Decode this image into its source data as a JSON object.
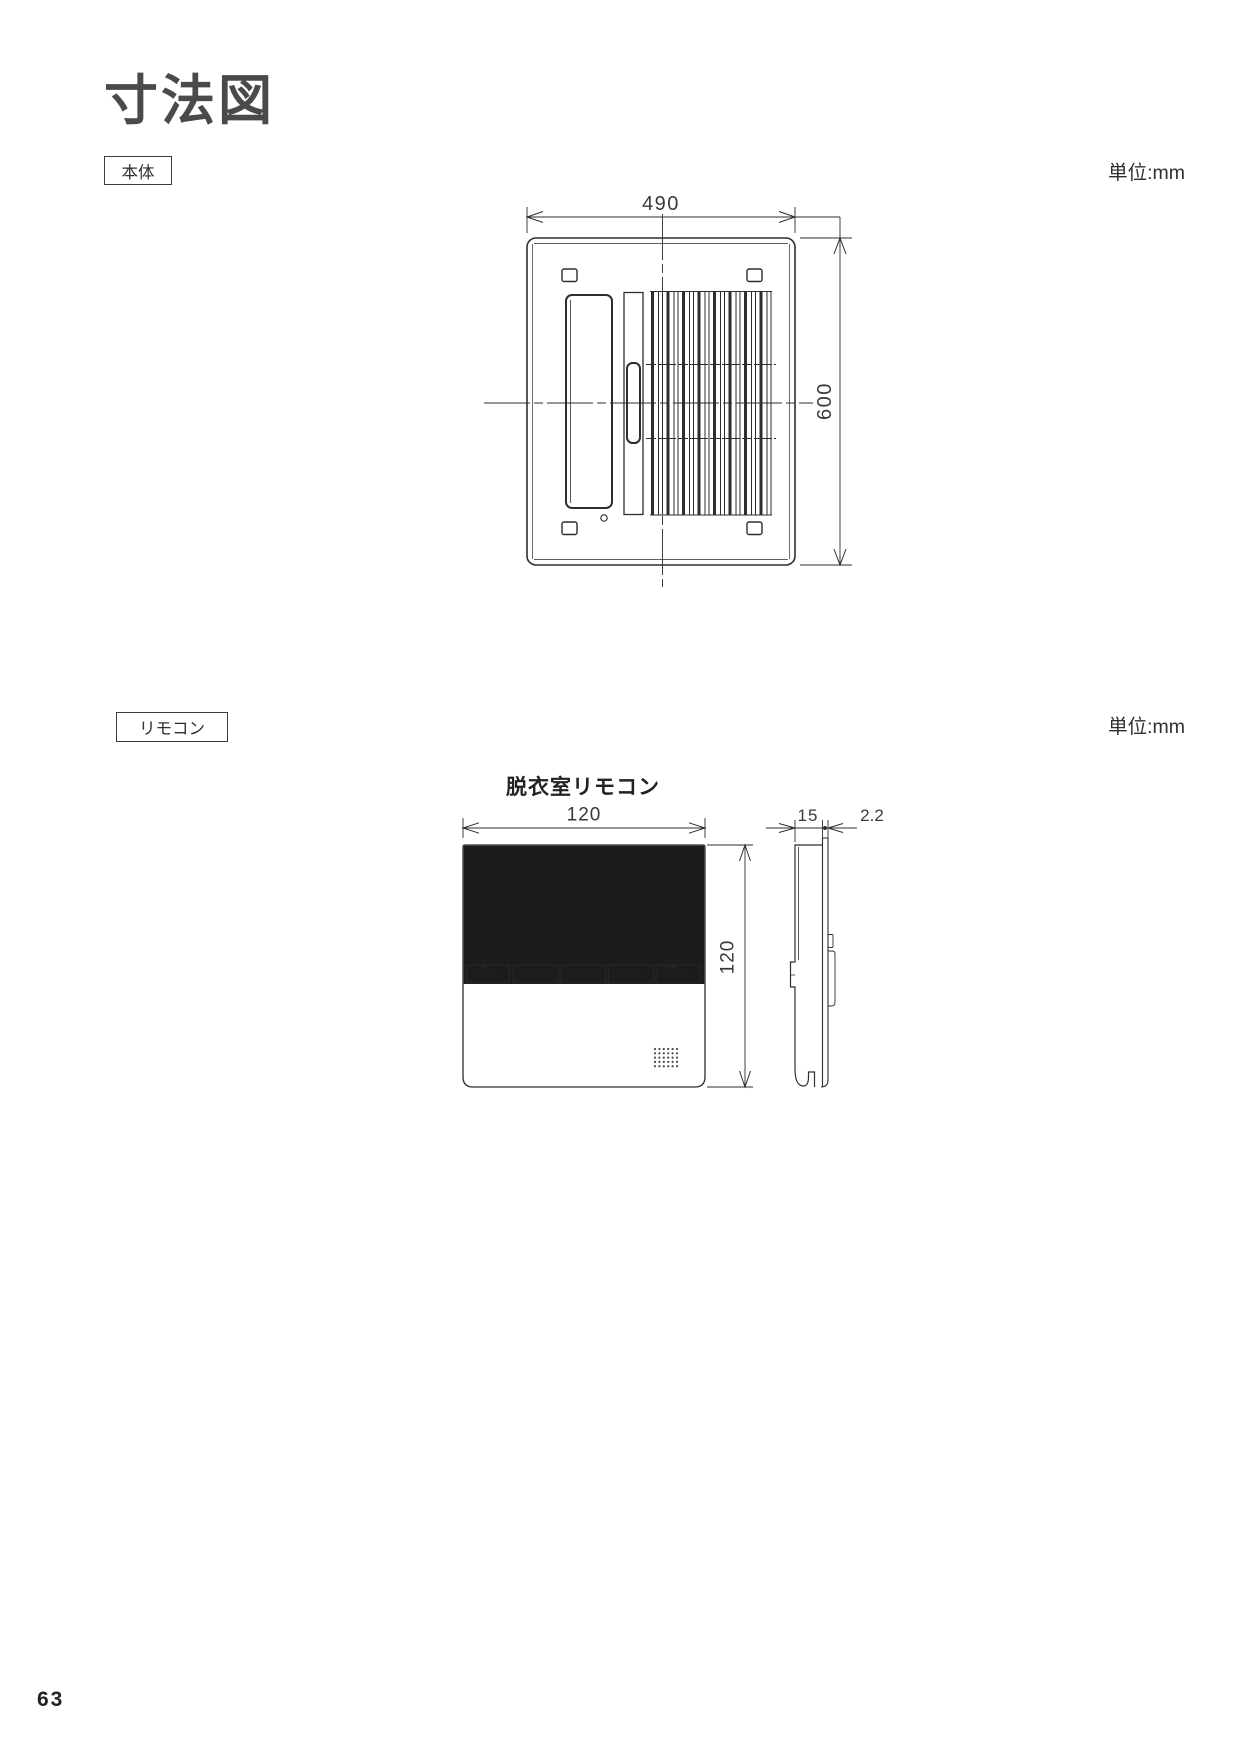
{
  "page": {
    "title": "寸法図",
    "number": "63"
  },
  "body_section": {
    "label": "本体",
    "unit": "単位:mm",
    "width_mm": "490",
    "height_mm": "600"
  },
  "remote_section": {
    "label": "リモコン",
    "unit": "単位:mm",
    "subtitle": "脱衣室リモコン",
    "front": {
      "width_mm": "120",
      "height_mm": "120",
      "buttons": [
        "暖房",
        "衣類乾燥",
        "浴室乾燥",
        "換気",
        "停止"
      ]
    },
    "side": {
      "depth_mm": "15",
      "thickness_mm": "2.2"
    }
  },
  "colors": {
    "line": "#2e2e2e",
    "screen": "#1c1c1e",
    "remote_body_fill": "#f8f8f7",
    "text": "#333333"
  }
}
